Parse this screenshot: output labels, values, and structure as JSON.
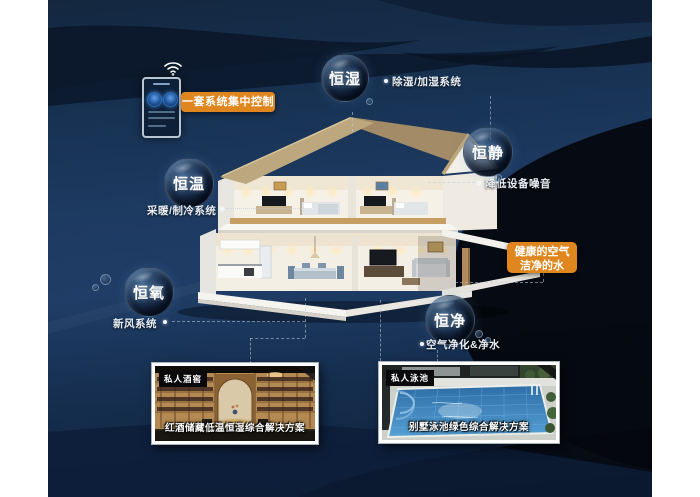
{
  "control_panel": {
    "label": "一套系统集中控制"
  },
  "highlight": {
    "line1": "健康的空气",
    "line2": "洁净的水"
  },
  "features": [
    {
      "name": "humidity",
      "bubble": "恒湿",
      "label": "除湿/加湿系统"
    },
    {
      "name": "quiet",
      "bubble": "恒静",
      "label": "降低设备噪音"
    },
    {
      "name": "temperature",
      "bubble": "恒温",
      "label": "采暖/制冷系统"
    },
    {
      "name": "oxygen",
      "bubble": "恒氧",
      "label": "新风系统"
    },
    {
      "name": "purity",
      "bubble": "恒净",
      "label": "空气净化&净水"
    }
  ],
  "cards": [
    {
      "tag": "私人酒窖",
      "caption": "红酒储藏低温恒湿综合解决方案"
    },
    {
      "tag": "私人泳池",
      "caption": "别墅泳池绿色综合解决方案"
    }
  ],
  "colors": {
    "accent_orange": "#e0861e",
    "canvas_navy": "#1e3a5f",
    "label_text": "#e8eef4"
  }
}
